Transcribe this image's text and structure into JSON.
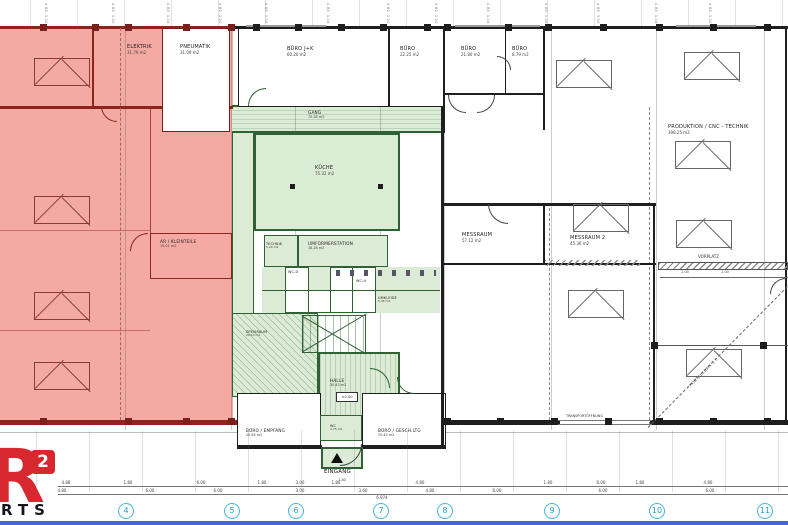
{
  "drawing": {
    "type": "architectural floor plan"
  },
  "colors": {
    "zone_red_fill": "#f5a9a3",
    "zone_red_wall": "#8f241d",
    "zone_green_fill": "#dcebd6",
    "zone_green_wall": "#2f6135",
    "wall_black": "#1f1f1f",
    "axis_cyan": "#45b5e0",
    "logo_red": "#d7282f",
    "footer_blue": "#4468c8"
  },
  "rooms": {
    "elektrik": {
      "name": "ELEKTRIK",
      "area": "31.79 m2"
    },
    "pneumatik": {
      "name": "PNEUMATIK",
      "area": "31.09 m2"
    },
    "ar_kleinteile": {
      "name": "AR / KLEINTEILE",
      "area": "19.01 m2"
    },
    "buero_jk": {
      "name": "BÜRO J+K",
      "area": "60.20 m2"
    },
    "buero_1": {
      "name": "BÜRO",
      "area": "22.25 m2"
    },
    "buero_2": {
      "name": "BÜRO",
      "area": "21.80 m2"
    },
    "buero_3": {
      "name": "BÜRO",
      "area": "8.79 m2"
    },
    "gang": {
      "name": "GANG",
      "area": "70.38 m2"
    },
    "kueche": {
      "name": "KÜCHE",
      "area": "75.32 m2"
    },
    "technik": {
      "name": "TECHNIK",
      "area": "5.20 m2"
    },
    "umformerstation": {
      "name": "UMFORMERSTATION",
      "area": "16.28 m2"
    },
    "wc_d": {
      "name": "WC-D"
    },
    "wc_h": {
      "name": "WC-H"
    },
    "umkleide": {
      "name": "UMKLEIDE",
      "area": "5.36 m2"
    },
    "speisraum": {
      "name": "SPEISRAUM",
      "area": "20.10 m2"
    },
    "halle": {
      "name": "HALLE",
      "area": "30.43 m2",
      "level": "±0.00"
    },
    "buero_empfang": {
      "name": "BÜRO / EMPFANG",
      "area": "20.65 m2"
    },
    "wc": {
      "name": "WC",
      "area": "4.75 m2"
    },
    "buero_gesch": {
      "name": "BÜRO / GESCH.LTG",
      "area": "20.43 m2"
    },
    "eingang": {
      "name": "EINGANG",
      "dim": "1.80"
    },
    "messraum_1": {
      "name": "MESSRAUM",
      "area": "57.12 m2"
    },
    "messraum_2": {
      "name": "MESSRAUM 2",
      "area": "45.36 m2"
    },
    "produktion": {
      "name": "PRODUKTION / CNC - TECHNIK",
      "area": "398.25 m2"
    },
    "vorplatz": {
      "name": "VORPLATZ"
    },
    "transport": {
      "name": "TRANSPORTÖFFNUNG"
    },
    "portalkran": {
      "name": "PORTALKRAN 5 t"
    }
  },
  "grid": {
    "axes": [
      "4",
      "5",
      "6",
      "7",
      "8",
      "9",
      "10",
      "11"
    ]
  },
  "dims": {
    "top_pair": "4.80  1.10",
    "row1": [
      "4.88",
      "1.80",
      "6.00",
      "1.80",
      "3.00",
      "1.80",
      "4.80",
      "1.80",
      "6.00",
      "1.80",
      "4.80"
    ],
    "row2": [
      "4.80",
      "6.00",
      "6.00",
      "3.00",
      "3.60",
      "4.80",
      "6.00",
      "6.00",
      "6.00"
    ],
    "total": "6.974",
    "vorplatz_ticks": [
      "2.00",
      "2.00"
    ]
  },
  "logo": {
    "letter": "R",
    "exponent": "2",
    "text": "RTS"
  }
}
